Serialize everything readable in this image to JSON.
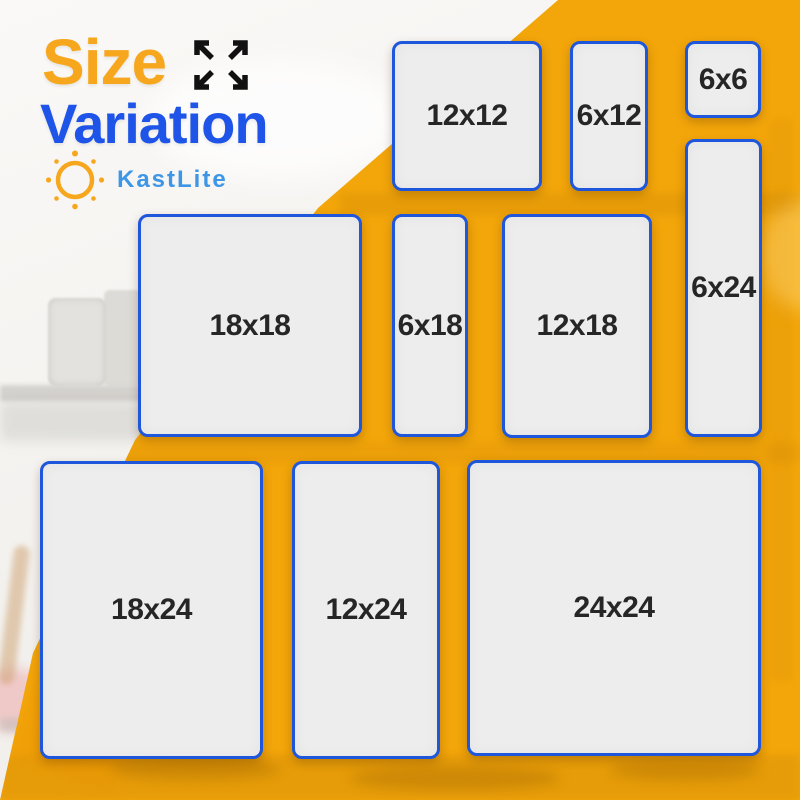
{
  "title": {
    "line1": "Size",
    "line2": "Variation"
  },
  "brand": {
    "name": "KastLite"
  },
  "icons": {
    "expand": "expand-arrows-icon",
    "brand_logo": "sun-icon"
  },
  "colors": {
    "accent_orange": "#F6A71E",
    "accent_blue": "#1E55E8",
    "brand_blue": "#3D96E6",
    "box_border_blue": "#1E56DC",
    "box_fill": "#EDEDEE",
    "label_text": "#262626",
    "background_yellow": "#F3A60A",
    "icon_black": "#111111"
  },
  "size_boxes": [
    {
      "label": "12x12",
      "x": 392,
      "y": 41,
      "w": 150,
      "h": 150
    },
    {
      "label": "6x12",
      "x": 570,
      "y": 41,
      "w": 78,
      "h": 150
    },
    {
      "label": "6x6",
      "x": 685,
      "y": 41,
      "w": 76,
      "h": 77
    },
    {
      "label": "6x24",
      "x": 685,
      "y": 139,
      "w": 77,
      "h": 298
    },
    {
      "label": "18x18",
      "x": 138,
      "y": 214,
      "w": 224,
      "h": 223
    },
    {
      "label": "6x18",
      "x": 392,
      "y": 214,
      "w": 76,
      "h": 223
    },
    {
      "label": "12x18",
      "x": 502,
      "y": 214,
      "w": 150,
      "h": 224
    },
    {
      "label": "18x24",
      "x": 40,
      "y": 461,
      "w": 223,
      "h": 298
    },
    {
      "label": "12x24",
      "x": 292,
      "y": 461,
      "w": 148,
      "h": 298
    },
    {
      "label": "24x24",
      "x": 467,
      "y": 460,
      "w": 294,
      "h": 296
    }
  ]
}
